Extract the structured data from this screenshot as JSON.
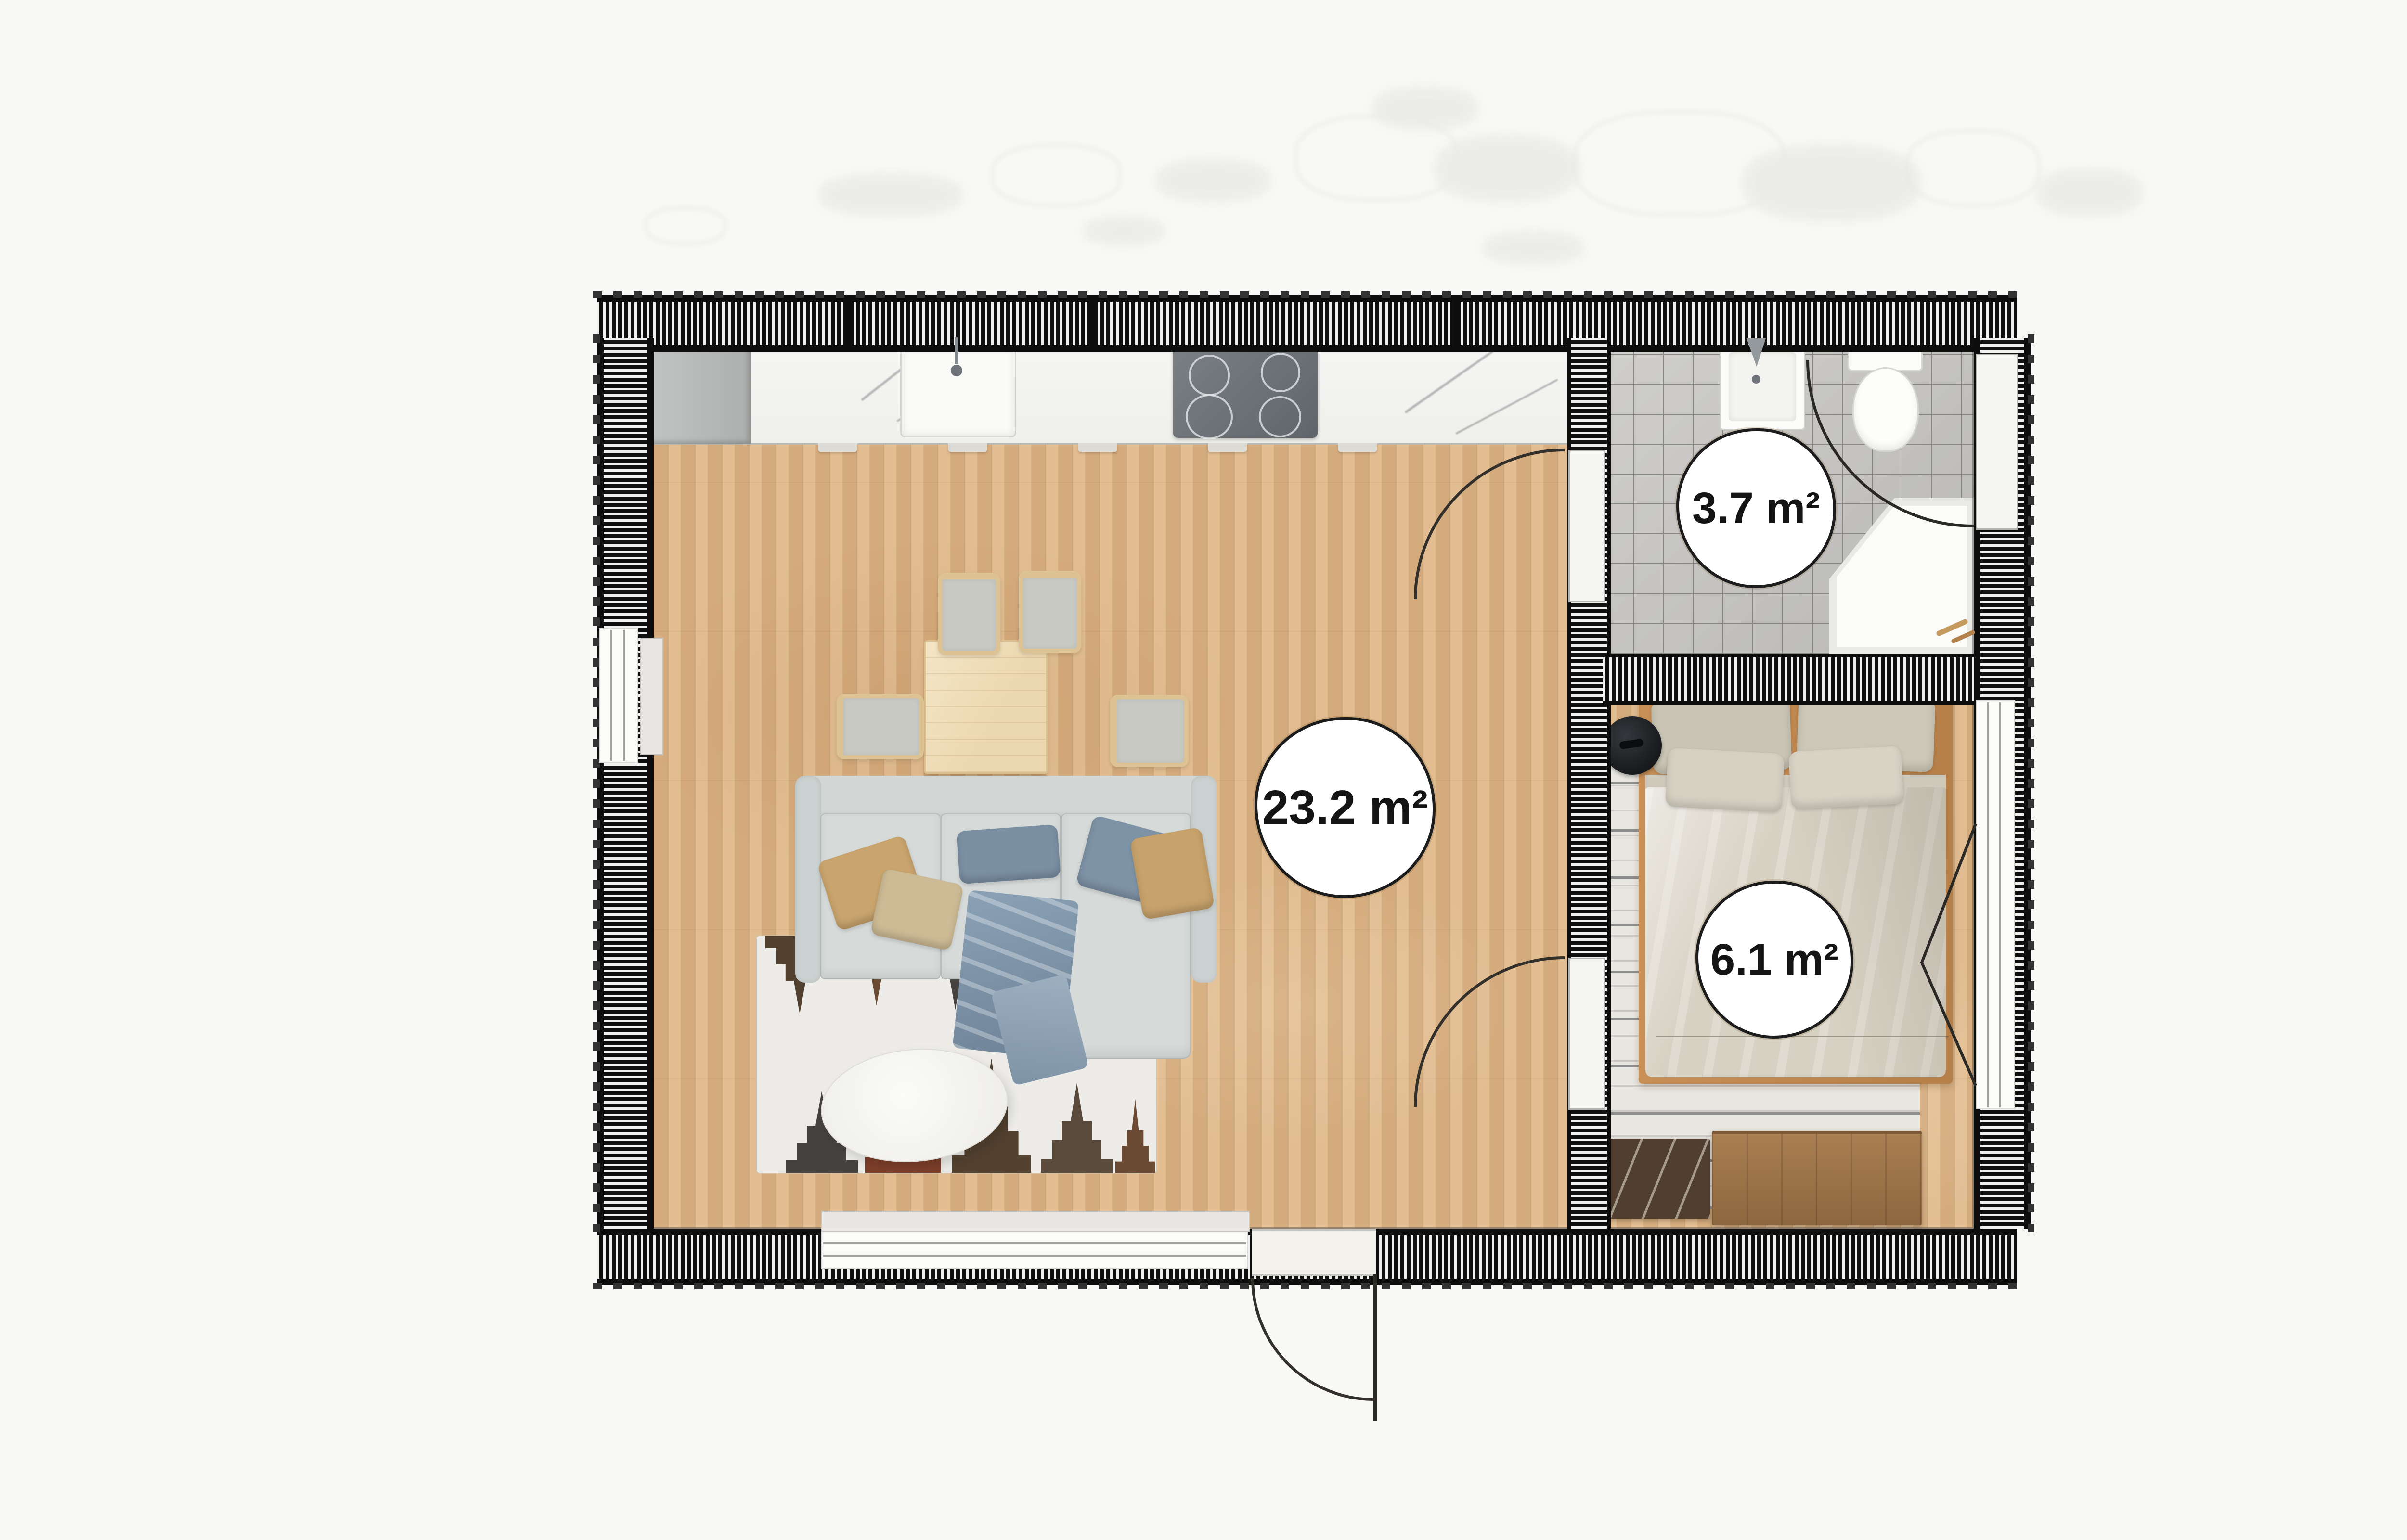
{
  "plan": {
    "type": "floor-plan",
    "rooms": [
      {
        "id": "living-kitchen",
        "label": "23.2 m²"
      },
      {
        "id": "bathroom",
        "label": "3.7 m²"
      },
      {
        "id": "bedroom",
        "label": "6.1 m²"
      }
    ]
  },
  "colors": {
    "page_bg": "#f8f8f6",
    "wall": "#0f0f0f",
    "floor_wood": "#dcb486",
    "floor_tile": "#c4c3c0",
    "sofa": "#d2d7d6",
    "bed": "#d7d1c3",
    "label_border": "#1c1c1c"
  }
}
